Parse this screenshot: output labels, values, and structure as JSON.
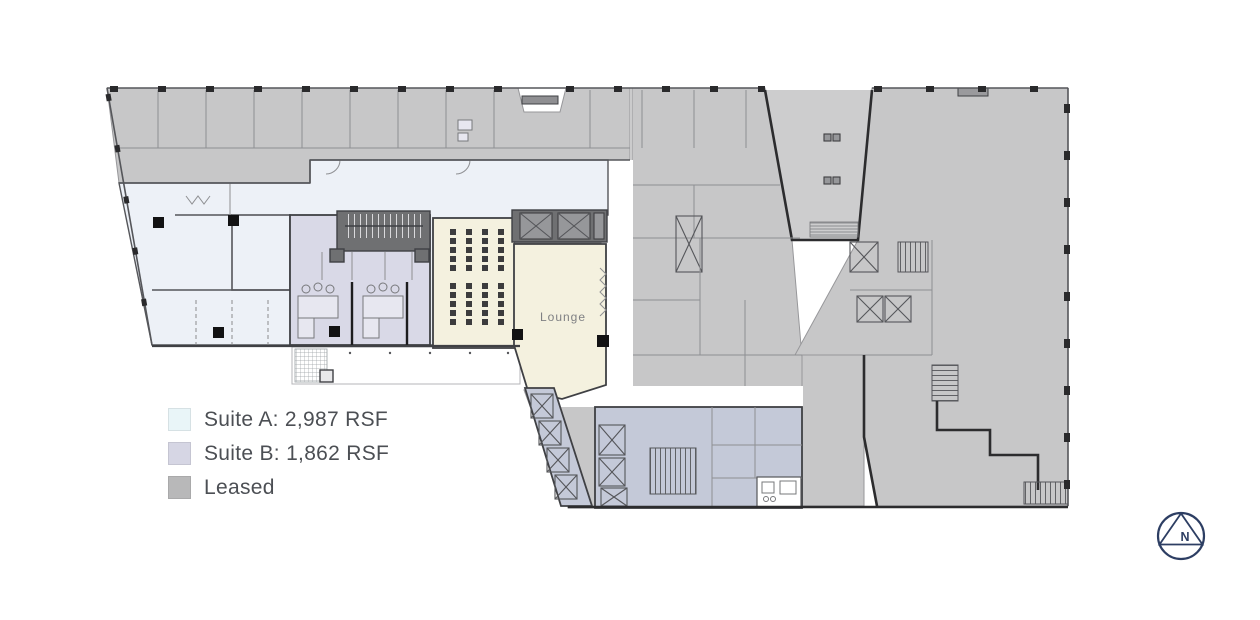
{
  "legend": {
    "items": [
      {
        "label": "Suite A: 2,987 RSF",
        "color": "#e9f5f8"
      },
      {
        "label": "Suite B: 1,862 RSF",
        "color": "#d6d6e4"
      },
      {
        "label": "Leased",
        "color": "#b8b8b9"
      }
    ]
  },
  "plan": {
    "lounge_label": "Lounge",
    "colors": {
      "leased": "#c7c7c8",
      "courtyard": "#cdcdce",
      "suite_a": "#edf1f7",
      "suite_b": "#d9d9e7",
      "cream": "#f4f1df",
      "core": "#c4c9d8",
      "dark_core": "#6f7072",
      "wall": "#3f4044"
    }
  },
  "compass": {
    "label": "N",
    "color": "#2d3e63"
  }
}
